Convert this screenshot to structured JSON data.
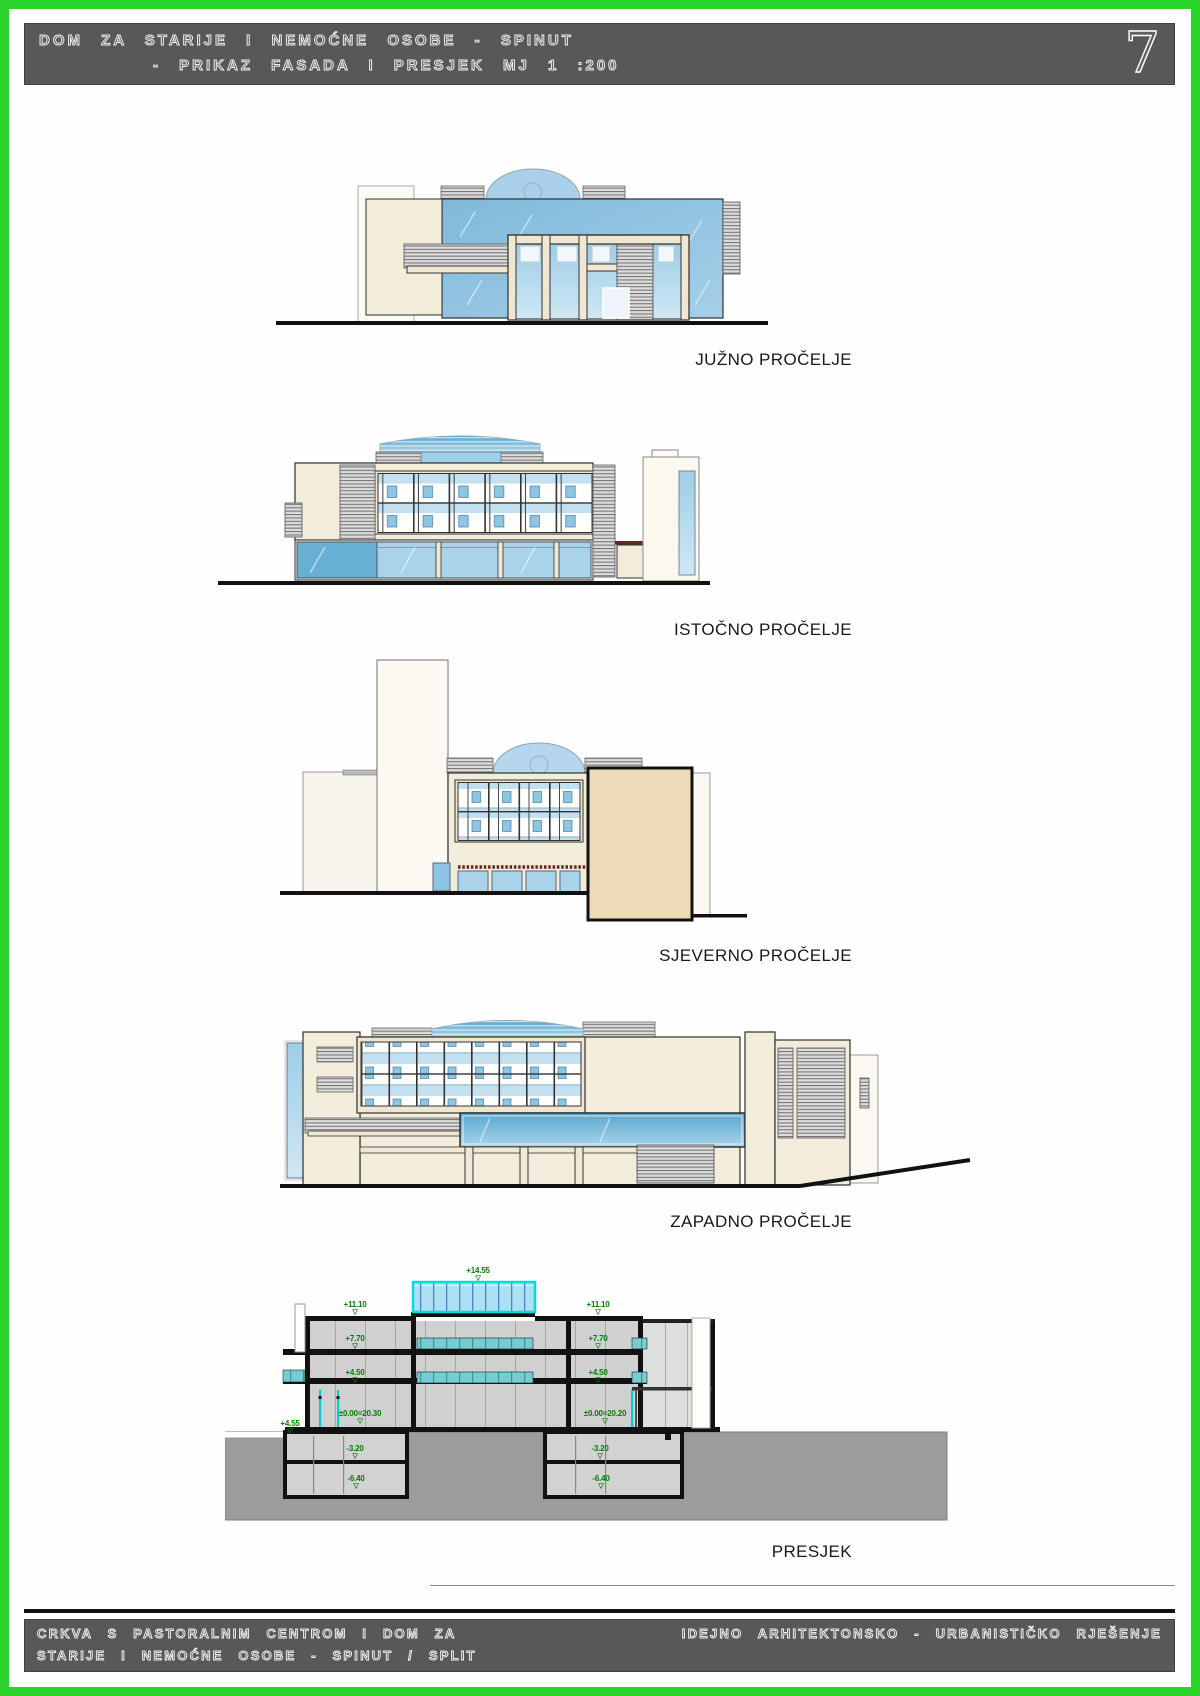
{
  "header": {
    "title_line1": "DOM ZA STARIJE I NEMOĆNE OSOBE - SPINUT",
    "title_line2": "- PRIKAZ FASADA I PRESJEK MJ 1 :200",
    "sheet_number": "7"
  },
  "drawings": {
    "south": {
      "label": "JUŽNO PROČELJE"
    },
    "east": {
      "label": "ISTOČNO PROČELJE"
    },
    "north": {
      "label": "SJEVERNO PROČELJE"
    },
    "west": {
      "label": "ZAPADNO PROČELJE"
    },
    "section": {
      "label": "PRESJEK",
      "annotations": {
        "roof": "+14.55",
        "left_1110": "+11.10",
        "right_1110": "+11.10",
        "left_770": "+7.70",
        "right_770": "+7.70",
        "left_450": "+4.50",
        "right_450": "+4.50",
        "left_000": "±0.00=20.30",
        "right_000": "±0.00=20.20",
        "terrain": "+4.55",
        "left_320": "-3.20",
        "right_320": "-3.20",
        "left_640": "-6.40",
        "right_640": "-6.40"
      }
    }
  },
  "footer": {
    "left_line1": "CRKVA S PASTORALNIM CENTROM I DOM ZA",
    "left_line2": "STARIJE I NEMOĆNE OSOBE - SPINUT / SPLIT",
    "right": "IDEJNO ARHITEKTONSKO - URBANISTIČKO RJEŠENJE"
  },
  "colors": {
    "page_border_green": "#2bd42b",
    "title_bar_gray": "#58585b",
    "annotation_green": "#067d06",
    "glass_blue": "#7fb9da",
    "wall_cream": "#f2ecda",
    "wall_tan": "#ecdbb6",
    "section_gray": "#d0d0d0",
    "terrain_gray": "#9c9c9c",
    "skylight_cyan": "#00dcdc",
    "awning_red": "#6e2222"
  }
}
